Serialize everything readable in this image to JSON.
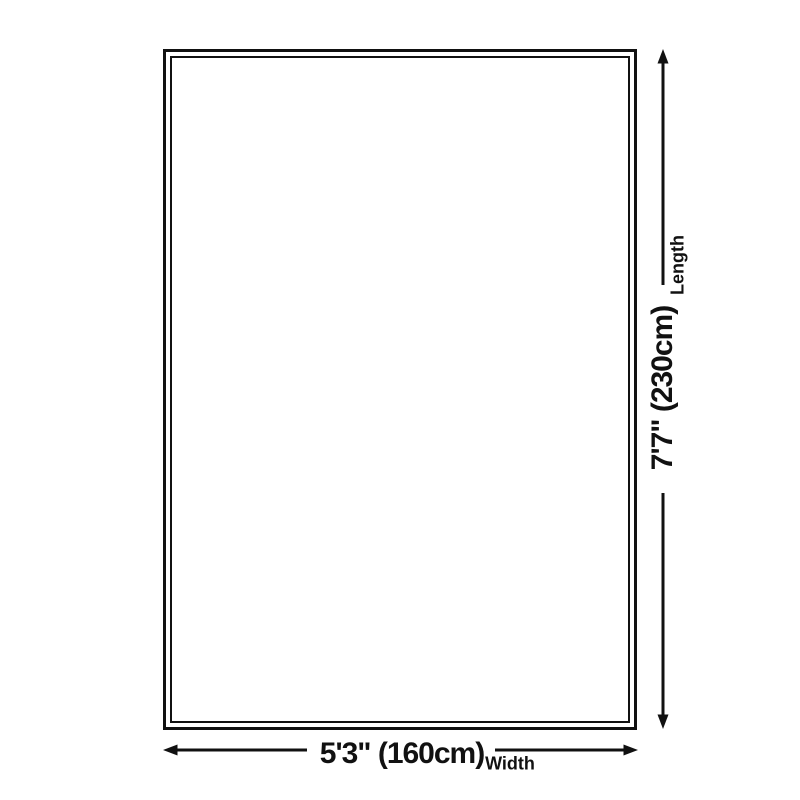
{
  "colors": {
    "line": "#111111",
    "text": "#111111",
    "background": "#ffffff"
  },
  "rug": {
    "shape": "rectangle-double-border"
  },
  "dimensions": {
    "length": {
      "value": "7'7\" (230cm)",
      "label": "Length",
      "icon": "double-headed-vertical-arrow"
    },
    "width": {
      "value": "5'3\" (160cm)",
      "label": "Width",
      "icon": "double-headed-horizontal-arrow"
    }
  }
}
